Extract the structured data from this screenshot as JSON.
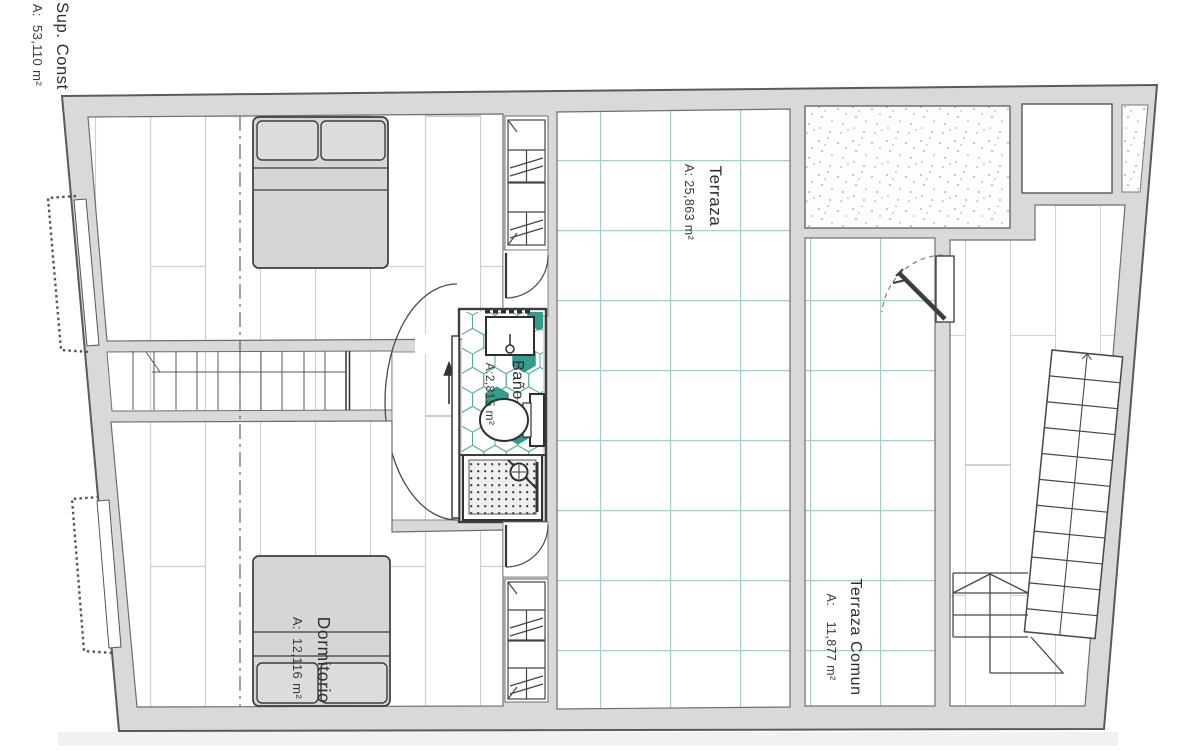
{
  "plan": {
    "title_block": {
      "name": "Sup. Const",
      "area": "A:  53,110 m²"
    },
    "rooms": {
      "terraza": {
        "name": "Terraza",
        "area": "A: 25,863 m²"
      },
      "bano": {
        "name": "Baño",
        "area": "A:2,815 m²"
      },
      "dormitorio": {
        "name": "Dormitorio",
        "area": "A:  12,116 m²"
      },
      "terraza_comun": {
        "name": "Terraza Comun",
        "area": "A:    11,877 m²"
      }
    },
    "colors": {
      "wall_fill": "#d9d9d9",
      "wall_line": "#5a5a5a",
      "tile_line": "#a5cdc9",
      "hex_line": "#52ab9e",
      "accent_teal": "#2f9e8c",
      "floor_line": "#cfcfcf",
      "ink": "#2e2e2e"
    }
  }
}
